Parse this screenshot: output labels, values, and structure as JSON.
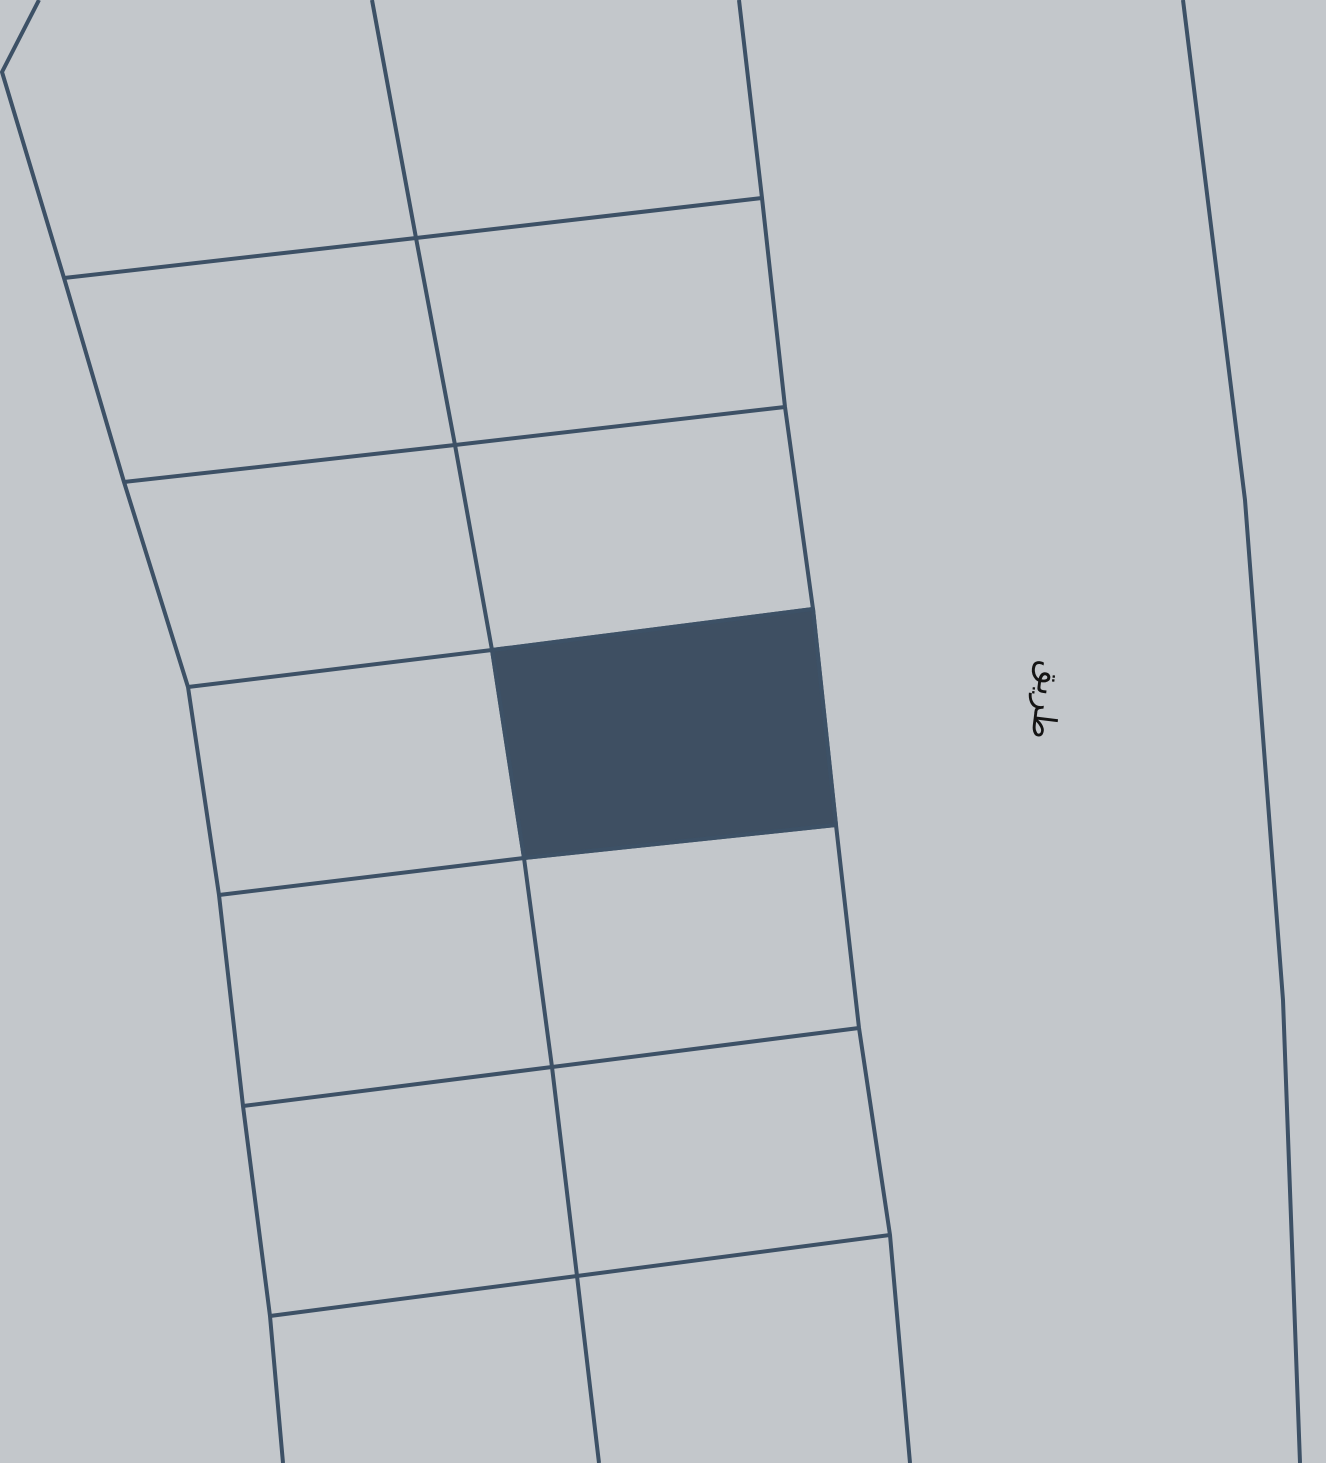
{
  "map": {
    "width": 1326,
    "height": 1463,
    "background_color": "#c3c7cb",
    "boundary_color": "#3d5166",
    "boundary_width": 4,
    "parcel_fill_color": "#3e4f62",
    "label": {
      "text": "طريق",
      "x": 1047,
      "y": 700,
      "rotation_deg": 97,
      "font_size": 32,
      "color": "#141414"
    },
    "selected_parcel": {
      "points": [
        [
          492,
          650
        ],
        [
          813,
          609
        ],
        [
          836,
          825
        ],
        [
          524,
          858
        ]
      ]
    },
    "boundaries": [
      {
        "name": "left-block-boundary",
        "points": [
          [
            39,
            0
          ],
          [
            2,
            72
          ],
          [
            64,
            278
          ],
          [
            124,
            482
          ],
          [
            188,
            687
          ],
          [
            219,
            895
          ],
          [
            243,
            1106
          ],
          [
            270,
            1316
          ],
          [
            283,
            1463
          ]
        ]
      },
      {
        "name": "middle-block-boundary",
        "points": [
          [
            372,
            0
          ],
          [
            416,
            238
          ],
          [
            455,
            445
          ],
          [
            492,
            650
          ],
          [
            524,
            858
          ],
          [
            552,
            1067
          ],
          [
            577,
            1276
          ],
          [
            599,
            1463
          ]
        ]
      },
      {
        "name": "right-block-boundary",
        "points": [
          [
            739,
            0
          ],
          [
            762,
            198
          ],
          [
            785,
            407
          ],
          [
            813,
            609
          ],
          [
            836,
            825
          ],
          [
            859,
            1028
          ],
          [
            890,
            1235
          ],
          [
            910,
            1463
          ]
        ]
      },
      {
        "name": "road-edge-boundary",
        "points": [
          [
            1183,
            0
          ],
          [
            1245,
            500
          ],
          [
            1283,
            1000
          ],
          [
            1300,
            1463
          ]
        ]
      },
      {
        "name": "cross-boundary-1",
        "points": [
          [
            64,
            278
          ],
          [
            416,
            238
          ],
          [
            762,
            198
          ]
        ]
      },
      {
        "name": "cross-boundary-2",
        "points": [
          [
            124,
            482
          ],
          [
            455,
            445
          ],
          [
            785,
            407
          ]
        ]
      },
      {
        "name": "cross-boundary-3",
        "points": [
          [
            188,
            687
          ],
          [
            492,
            650
          ],
          [
            813,
            609
          ]
        ]
      },
      {
        "name": "cross-boundary-4",
        "points": [
          [
            219,
            895
          ],
          [
            524,
            858
          ],
          [
            836,
            825
          ]
        ]
      },
      {
        "name": "cross-boundary-5",
        "points": [
          [
            243,
            1106
          ],
          [
            552,
            1067
          ],
          [
            859,
            1028
          ]
        ]
      },
      {
        "name": "cross-boundary-6",
        "points": [
          [
            270,
            1316
          ],
          [
            577,
            1276
          ],
          [
            890,
            1235
          ]
        ]
      }
    ]
  }
}
